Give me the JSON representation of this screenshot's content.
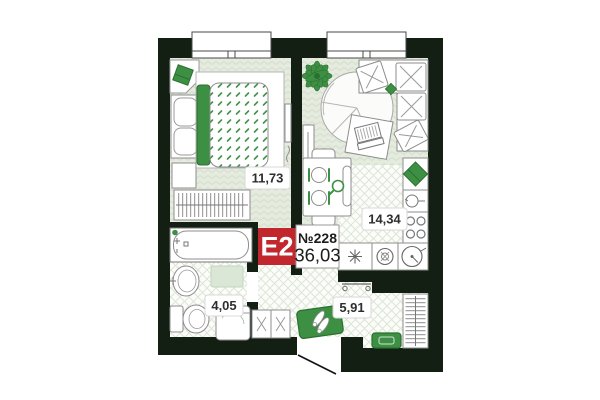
{
  "plan": {
    "badge": {
      "type": "E2",
      "number": "№228",
      "total_area": "36,03"
    },
    "rooms": [
      {
        "id": "bedroom",
        "area": "11,73"
      },
      {
        "id": "kitchen-living",
        "area": "14,34"
      },
      {
        "id": "bathroom",
        "area": "4,05"
      },
      {
        "id": "hallway",
        "area": "5,91"
      }
    ],
    "furniture": {
      "bedroom": [
        "corner-shelf-with-decor",
        "wardrobe",
        "double-bed",
        "nightstand",
        "clothes-rack",
        "tv"
      ],
      "kitchen_living": [
        "plant",
        "tv-console",
        "round-rug",
        "desk-with-laptop",
        "corner-sofa",
        "dining-table-with-chairs",
        "decor-shelf",
        "pot",
        "cooktop",
        "kitchen-counter",
        "washer",
        "sink"
      ],
      "bathroom": [
        "bathtub",
        "washbasin",
        "bath-mat",
        "toilet",
        "washing-machine"
      ],
      "hallway": [
        "coat-rack",
        "shoe-cabinet",
        "doormat-with-shoes",
        "bench",
        "open-wardrobe"
      ]
    },
    "colors": {
      "wall": "#121f12",
      "accent_green": "#3d9043",
      "accent_green_dark": "#2c6f32",
      "badge_red": "#c1272d",
      "floor_herringbone": "#e5ebde",
      "floor_tile": "#fcfdfb",
      "pattern_line": "#d2decb"
    }
  }
}
